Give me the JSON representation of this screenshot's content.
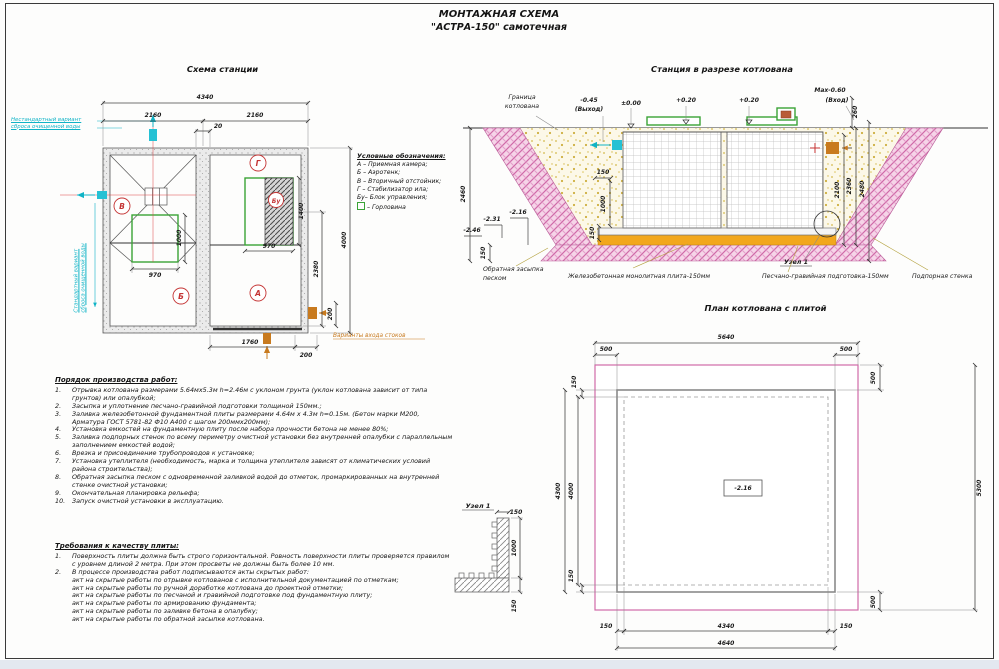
{
  "page": {
    "title1": "МОНТАЖНАЯ СХЕМА",
    "title2": "\"АСТРА-150\" самотечная"
  },
  "station": {
    "heading": "Схема станции",
    "dim_total_w": "4340",
    "dim_left_w": "2160",
    "dim_right_w": "2160",
    "dim_gap": "20",
    "dim_neck1_w": "970",
    "dim_neck1_h": "1000",
    "dim_neck2_w": "970",
    "dim_neck2_h": "1400",
    "dim_h": "4000",
    "dim_h_part": "2380",
    "dim_off_r": "200",
    "dim_bottom": "1760",
    "dim_off_b": "200",
    "label_a": "А",
    "label_b": "Б",
    "label_v": "В",
    "label_g": "Г",
    "label_bu": "Бу",
    "note_alt_1": "Нестандартный вариант",
    "note_alt_2": "сброса очищенной воды",
    "note_std_1": "Стандартный вариант",
    "note_std_2": "сброса очищенной воды",
    "note_inlet": "Варианты входа стоков"
  },
  "legend": {
    "heading": "Условные обозначения:",
    "items": [
      "А – Приемная камера;",
      "Б – Аэротенк;",
      "В – Вторичный отстойник;",
      "Г – Стабилизатор ила;",
      "Бу– Блок управления;"
    ],
    "neck": "– Горловина"
  },
  "section": {
    "heading": "Станция в разрезе котлована",
    "boundary_1": "Граница",
    "boundary_2": "котлована",
    "mark_out": "-0.45",
    "mark_out2": "(Выход)",
    "mark_zero": "±0.00",
    "mark_p20a": "+0.20",
    "mark_p20b": "+0.20",
    "mark_max": "Max-0.60",
    "mark_in": "(Вход)",
    "dim_260": "260",
    "dim_2460": "2460",
    "dim_150a": "150",
    "dim_1000": "1000",
    "dim_150b": "150",
    "mark_m216": "-2.16",
    "mark_m231": "-2.31",
    "mark_m246": "-2.46",
    "dim_150c": "150",
    "dim_2100": "2100",
    "dim_2360": "2360",
    "dim_2480": "2480",
    "node_ref": "Узел 1",
    "lbl_backfill_1": "Обратная засыпка",
    "lbl_backfill_2": "песком",
    "lbl_slab": "Железобетонная монолитная плита-150мм",
    "lbl_bed": "Песчано-гравийная подготовка-150мм",
    "lbl_wall": "Подпорная стенка"
  },
  "plan": {
    "heading": "План котлована с плитой",
    "dim_5640": "5640",
    "dim_500_tl": "500",
    "dim_500_tr": "500",
    "dim_150_lt": "150",
    "dim_500_rt": "500",
    "dim_4300": "4300",
    "dim_4000": "4000",
    "dim_5300": "5300",
    "dim_150_lb": "150",
    "dim_500_rb": "500",
    "dim_150_bl": "150",
    "dim_4340": "4340",
    "dim_150_br": "150",
    "dim_4640": "4640",
    "mark_depth": "-2.16"
  },
  "node1": {
    "heading": "Узел 1",
    "dim_150t": "150",
    "dim_1000": "1000",
    "dim_150b": "150"
  },
  "work_order": {
    "heading": "Порядок производства работ:",
    "items": [
      {
        "n": "1.",
        "t": "Отрывка котлована размерами 5.64мх5.3м h=2.46м с уклоном грунта (уклон котлована зависит от типа грунтов) или опалубкой;"
      },
      {
        "n": "2.",
        "t": "Засыпка и уплотнение песчано-гравийной подготовки толщиной 150мм.;"
      },
      {
        "n": "3.",
        "t": "Заливка железобетонной фундаментной плиты размерами 4.64м х 4.3м h=0.15м. (Бетон марки М200, Арматура ГОСТ 5781-82 Ф10 А400 с шагом 200ммх200мм);"
      },
      {
        "n": "4.",
        "t": "Установка емкостей на фундаментную плиту после набора прочности бетона не менее 80%;"
      },
      {
        "n": "5.",
        "t": "Заливка подпорных стенок по всему периметру очистной установки без внутренней опалубки с параллельным заполнением емкостей водой;"
      },
      {
        "n": "6.",
        "t": "Врезка и присоединение трубопроводов к установке;"
      },
      {
        "n": "7.",
        "t": "Установка утеплителя (необходимость, марка и толщина утеплителя зависят от климатических условий района строительства);"
      },
      {
        "n": "8.",
        "t": "Обратная засыпка песком с одновременной заливкой водой до отметок, промаркированных на внутренней стенке очистной установки;"
      },
      {
        "n": "9.",
        "t": "Окончательная планировка рельефа;"
      },
      {
        "n": "10.",
        "t": "Запуск очистной установки в эксплуатацию."
      }
    ]
  },
  "quality": {
    "heading": "Требования к качеству плиты:",
    "items": [
      {
        "n": "1.",
        "t": "Поверхность плиты должна быть строго горизонтальной. Ровность поверхности плиты проверяется правилом с уровнем длиной 2 метра. При этом просветы не должны быть более 10 мм."
      },
      {
        "n": "2.",
        "t": "В процессе производства работ подписываются акты скрытых работ:"
      }
    ],
    "acts": [
      "акт на скрытые работы по отрывке котлованов с исполнительной документацией по отметкам;",
      "акт на скрытые работы по ручной доработке котлована до проектной отметки;",
      "акт на скрытые работы по песчаной и гравийной подготовке под фундаментную плиту;",
      "акт на скрытые работы по армированию фундамента;",
      "акт на скрытые работы по заливке бетона в опалубку;",
      "акт на скрытые работы по обратной засыпке котлована."
    ]
  },
  "colors": {
    "cyan": "#0fb3c6",
    "green": "#3aa336",
    "red": "#c43333",
    "orange": "#c87a1e",
    "bed_orange": "#f2a71d",
    "pink": "#d06aa8"
  }
}
